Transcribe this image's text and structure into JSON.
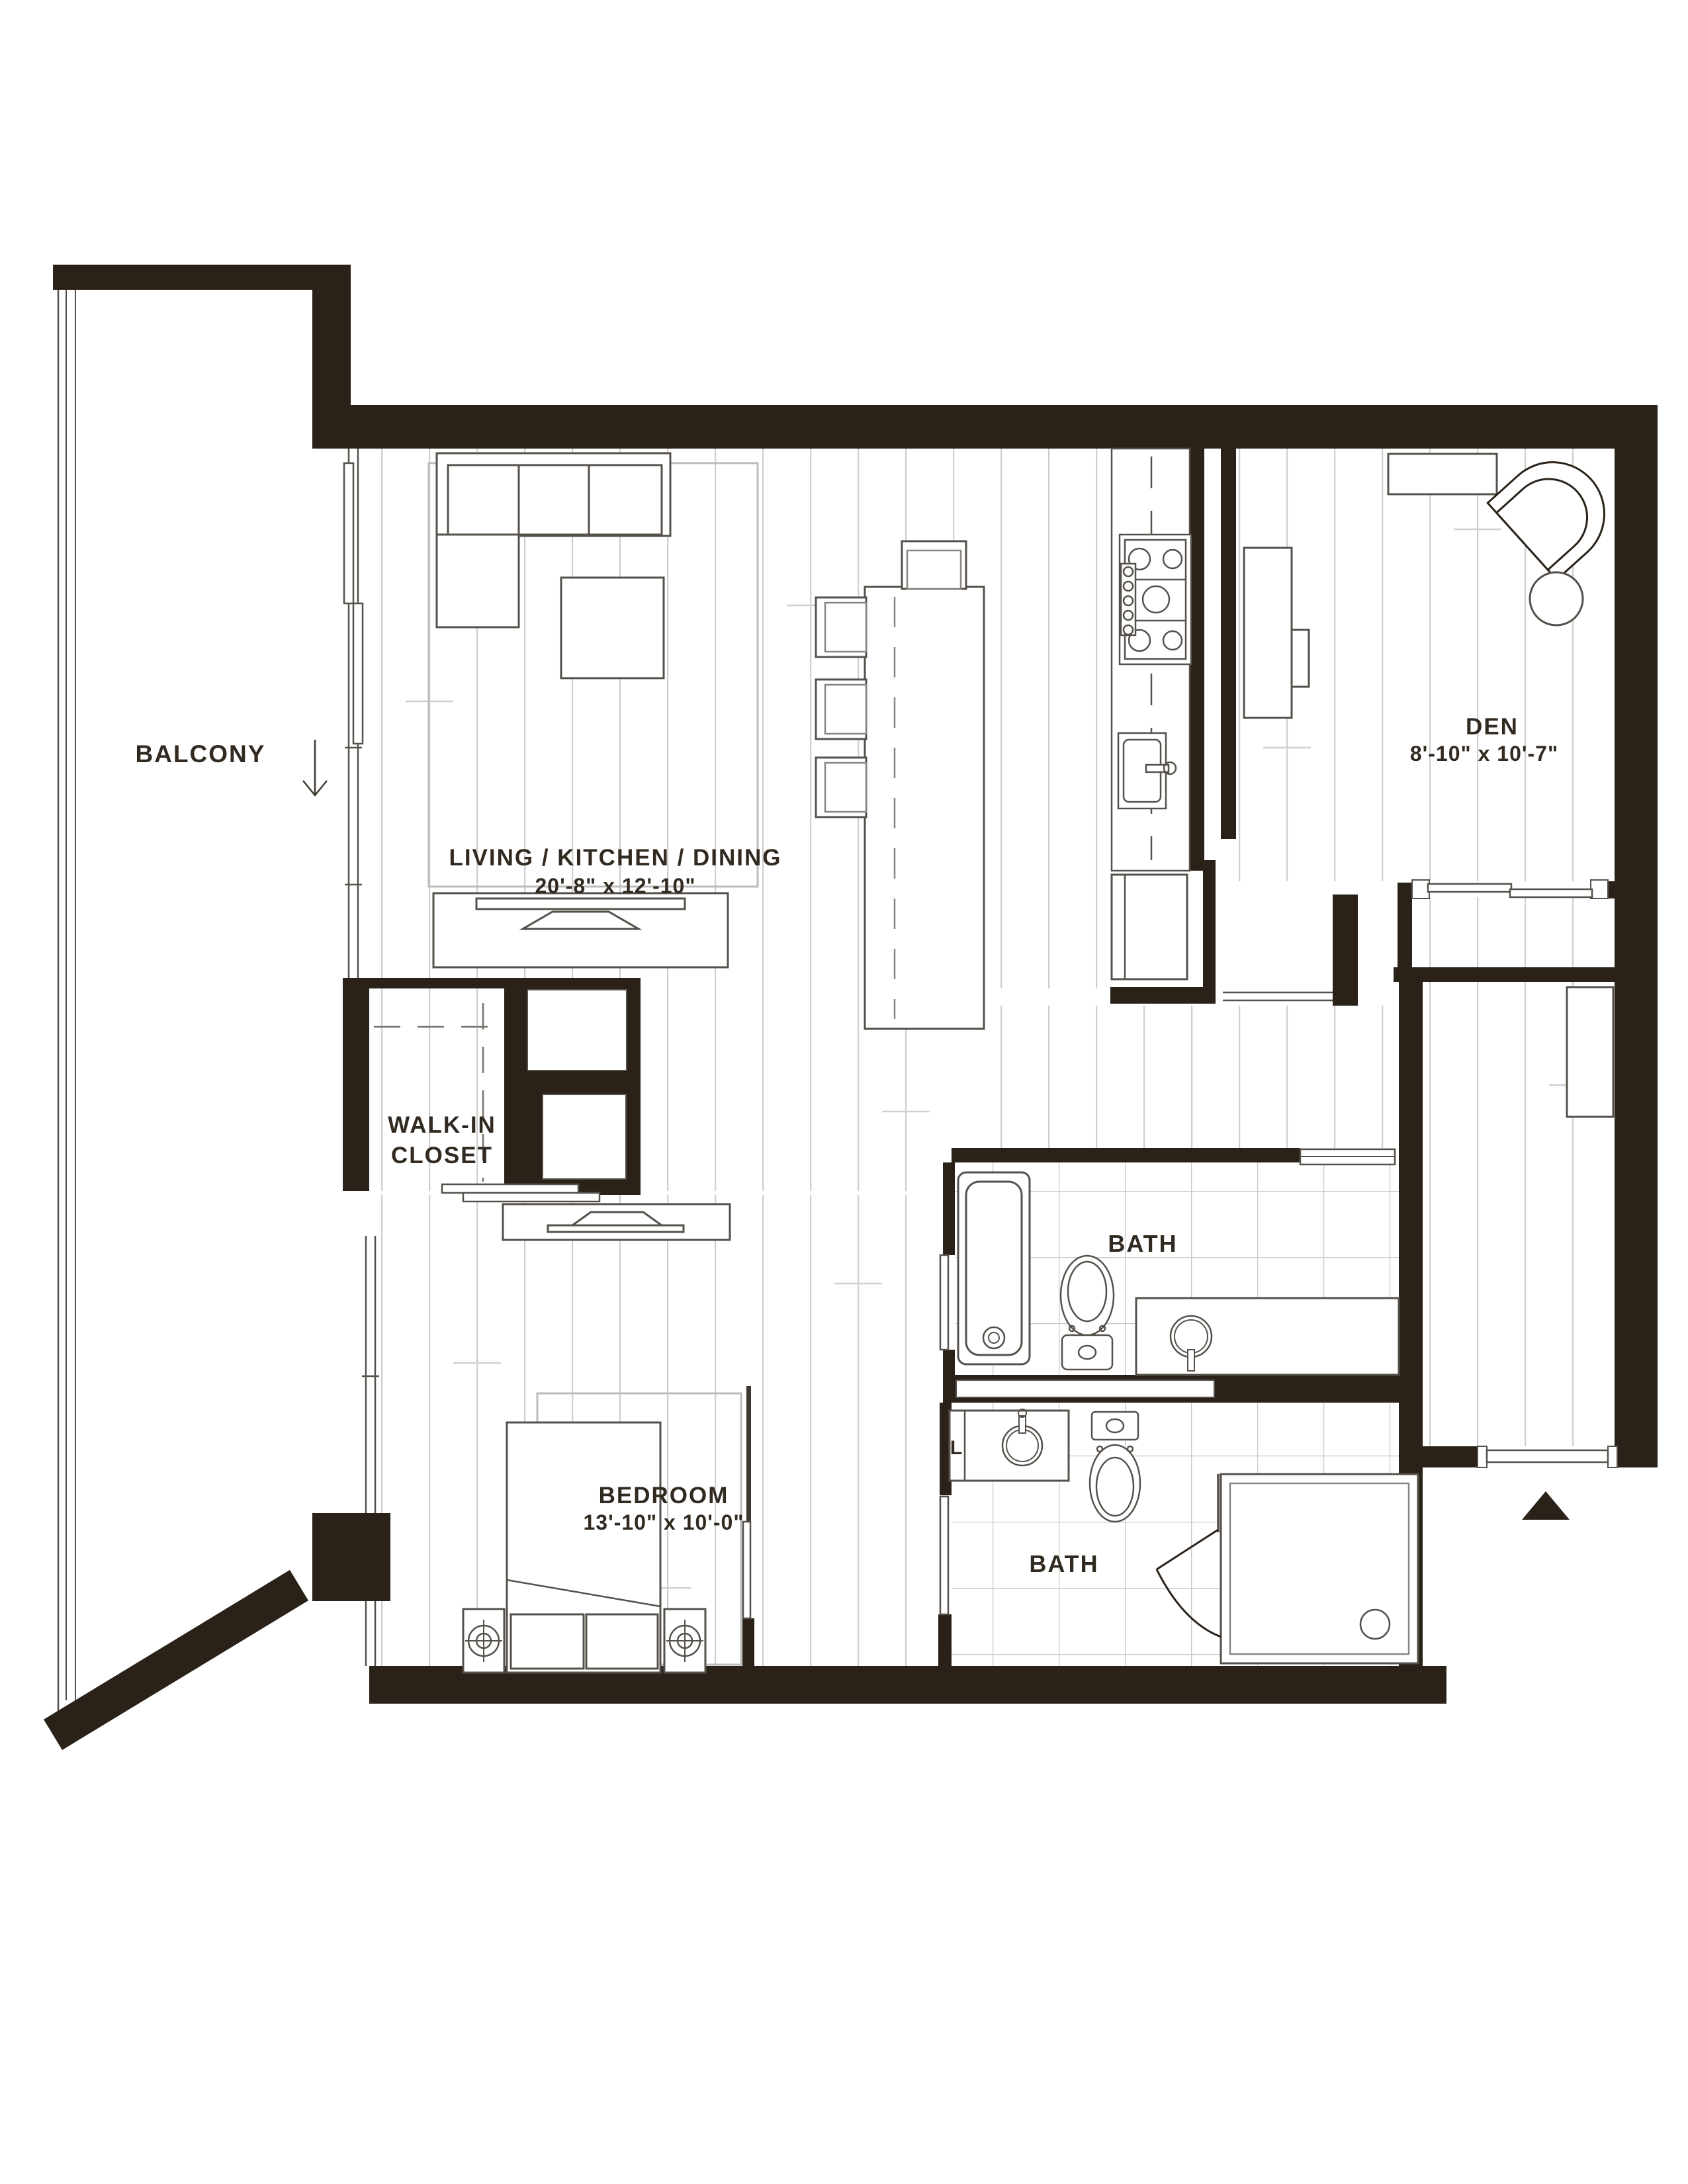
{
  "plan": {
    "type": "apartment-floor-plan",
    "colors": {
      "wall": "#2a2219",
      "line": "#3f3830",
      "plank_line": "#cfcfcf",
      "tile_line": "#c8c8c8",
      "text": "#322a20",
      "background": "#ffffff"
    },
    "icons": {
      "balcony_arrow": "down-arrow-icon",
      "entry_marker": "up-triangle-icon"
    }
  },
  "rooms": {
    "balcony": {
      "name": "BALCONY"
    },
    "living": {
      "name": "LIVING / KITCHEN / DINING",
      "dimensions": "20'-8\" x 12'-10\""
    },
    "den": {
      "name": "DEN",
      "dimensions": "8'-10\" x 10'-7\""
    },
    "walk_in_closet": {
      "line1": "WALK-IN",
      "line2": "CLOSET"
    },
    "bedroom": {
      "name": "BEDROOM",
      "dimensions": "13'-10\" x 10'-0\""
    },
    "bath_upper": {
      "name": "BATH"
    },
    "bath_lower": {
      "name": "BATH"
    },
    "laundry": {
      "abbr": "L"
    }
  }
}
